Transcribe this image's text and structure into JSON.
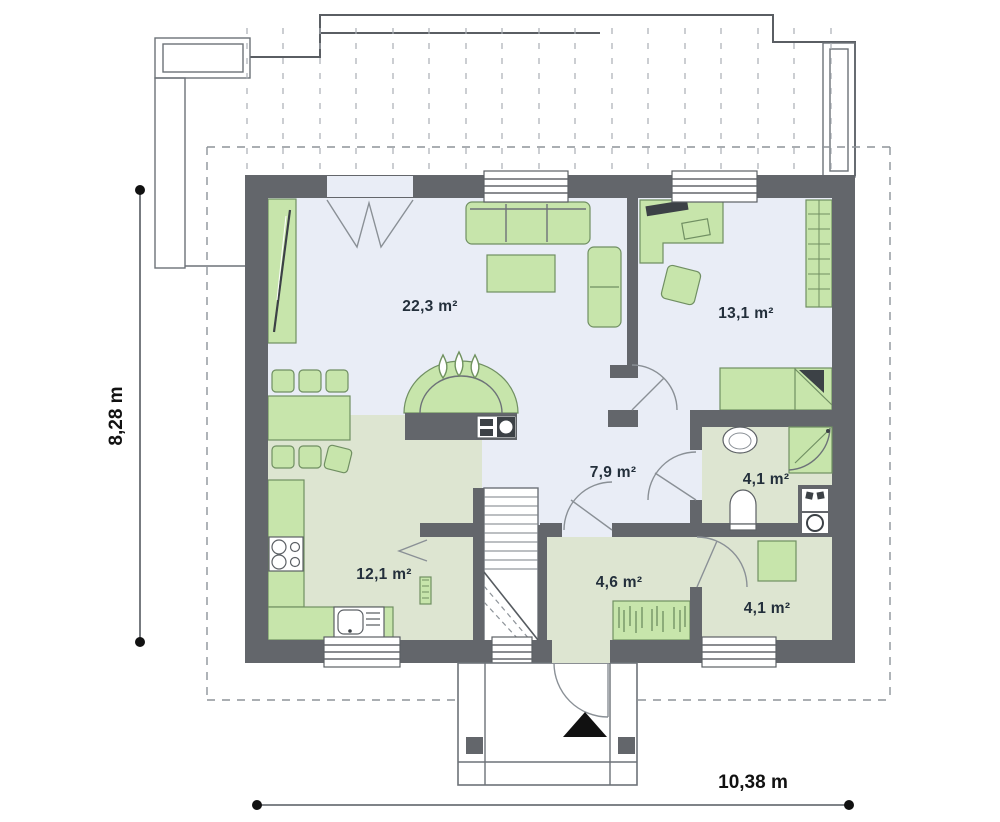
{
  "title": "Single-storey house floor plan",
  "rooms": [
    {
      "id": "living-room",
      "area_label": "22,3 m²"
    },
    {
      "id": "bedroom",
      "area_label": "13,1 m²"
    },
    {
      "id": "hall",
      "area_label": "7,9 m²"
    },
    {
      "id": "bathroom",
      "area_label": "4,1 m²"
    },
    {
      "id": "kitchen",
      "area_label": "12,1 m²"
    },
    {
      "id": "entry",
      "area_label": "4,6 m²"
    },
    {
      "id": "storage",
      "area_label": "4,1 m²"
    }
  ],
  "dimensions": {
    "height_label": "8,28 m",
    "width_label": "10,38 m"
  },
  "colors": {
    "wall": "#63666b",
    "floor_blue": "#e9edf6",
    "floor_green": "#dde5d1",
    "furniture_green": "#c7e5ab",
    "label_text": "#232f3b"
  }
}
